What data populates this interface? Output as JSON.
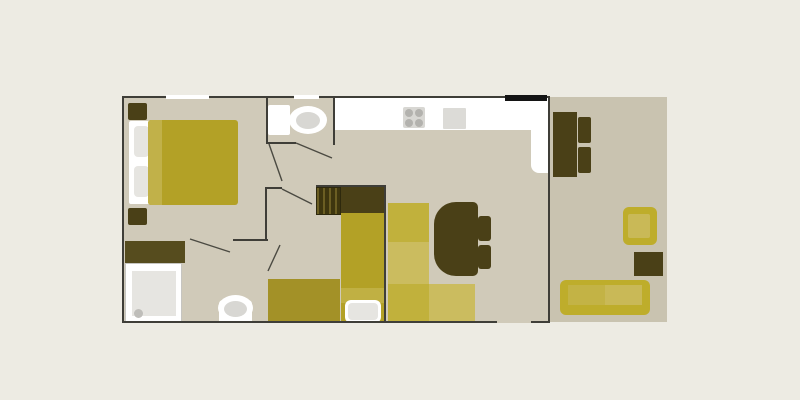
{
  "title": "apartment-floor-plan",
  "palette": {
    "page_bg": "#edebe3",
    "interior": "#d0cab9",
    "terrace_floor": "#c9c3b0",
    "wall": "#3f3e38",
    "door_black": "#141414",
    "white": "#ffffff",
    "gray_light": "#e6e5e1",
    "gray_mid": "#d8d7d3",
    "gray_dark": "#bfbeba",
    "sink_gray": "#dcdbd7",
    "burner_gray": "#b3b2ae",
    "olive_dark": "#4a4017",
    "olive_wardrobe": "#564c1e",
    "mustard": "#b3a126",
    "mustard_stripe": "#c1b149",
    "mustard_band": "#c0b043",
    "mustard_dark": "#a39127",
    "sofa_dark": "#c1b13c",
    "sofa_light": "#cbbc5f",
    "terrace_sofa": "#bead2b",
    "terrace_cushion": "#c9b957",
    "terrace_cushion_dark": "#c3b345",
    "stairs_dark": "#3e360f",
    "stairs_light": "#6b5e23"
  },
  "floor_plan": {
    "rooms": [
      {
        "name": "master-bedroom",
        "furniture": [
          "double-bed",
          "pillows",
          "nightstand",
          "nightstand",
          "window"
        ]
      },
      {
        "name": "bathroom",
        "furniture": [
          "wardrobe-cabinet",
          "shower",
          "toilet"
        ]
      },
      {
        "name": "wc",
        "furniture": [
          "toilet",
          "window"
        ]
      },
      {
        "name": "kids-room",
        "furniture": [
          "stairs",
          "head-cabinet",
          "single-bed",
          "bench-bed"
        ]
      },
      {
        "name": "kitchen-living-room",
        "furniture": [
          "kitchen-counter",
          "stove",
          "sink",
          "entry-door",
          "corner-sofa",
          "dining-table",
          "chair",
          "chair"
        ]
      },
      {
        "name": "terrace",
        "furniture": [
          "wall-table",
          "chair",
          "chair",
          "armchair",
          "side-table",
          "sofa"
        ]
      }
    ],
    "door_swings": [
      {
        "from": [
          296,
          143
        ],
        "to": [
          332,
          158
        ]
      },
      {
        "from": [
          269,
          144
        ],
        "to": [
          282,
          181
        ]
      },
      {
        "from": [
          282,
          189
        ],
        "to": [
          312,
          204
        ]
      },
      {
        "from": [
          190,
          239
        ],
        "to": [
          230,
          252
        ]
      },
      {
        "from": [
          280,
          245
        ],
        "to": [
          268,
          271
        ]
      }
    ]
  }
}
